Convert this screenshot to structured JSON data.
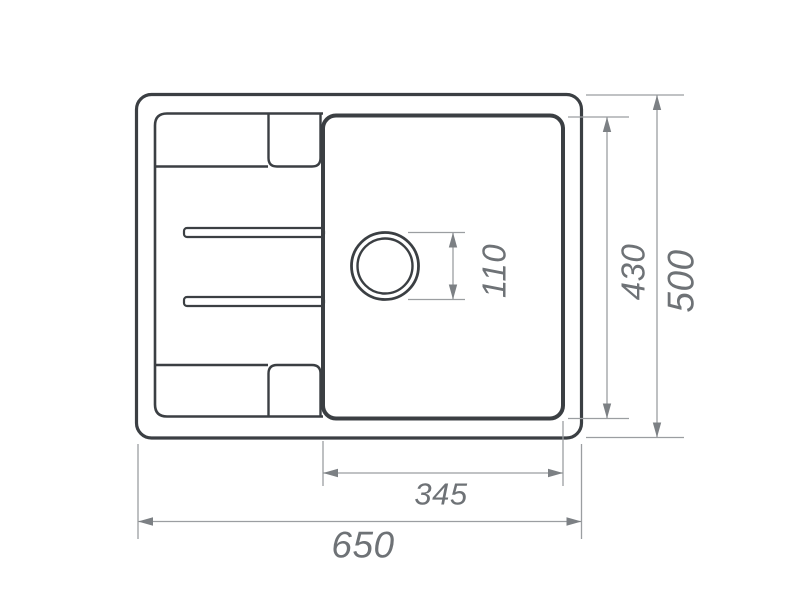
{
  "drawing": {
    "background": "#ffffff",
    "line_color": "#3b3f43",
    "dimension_color": "#9b9ea1",
    "dimension_arrow_color": "#7c8084",
    "dimension_text_color": "#6e7276",
    "dims": {
      "overall_width": "650",
      "overall_depth": "500",
      "bowl_depth": "430",
      "bowl_width": "345",
      "drain_hole": "110"
    }
  }
}
